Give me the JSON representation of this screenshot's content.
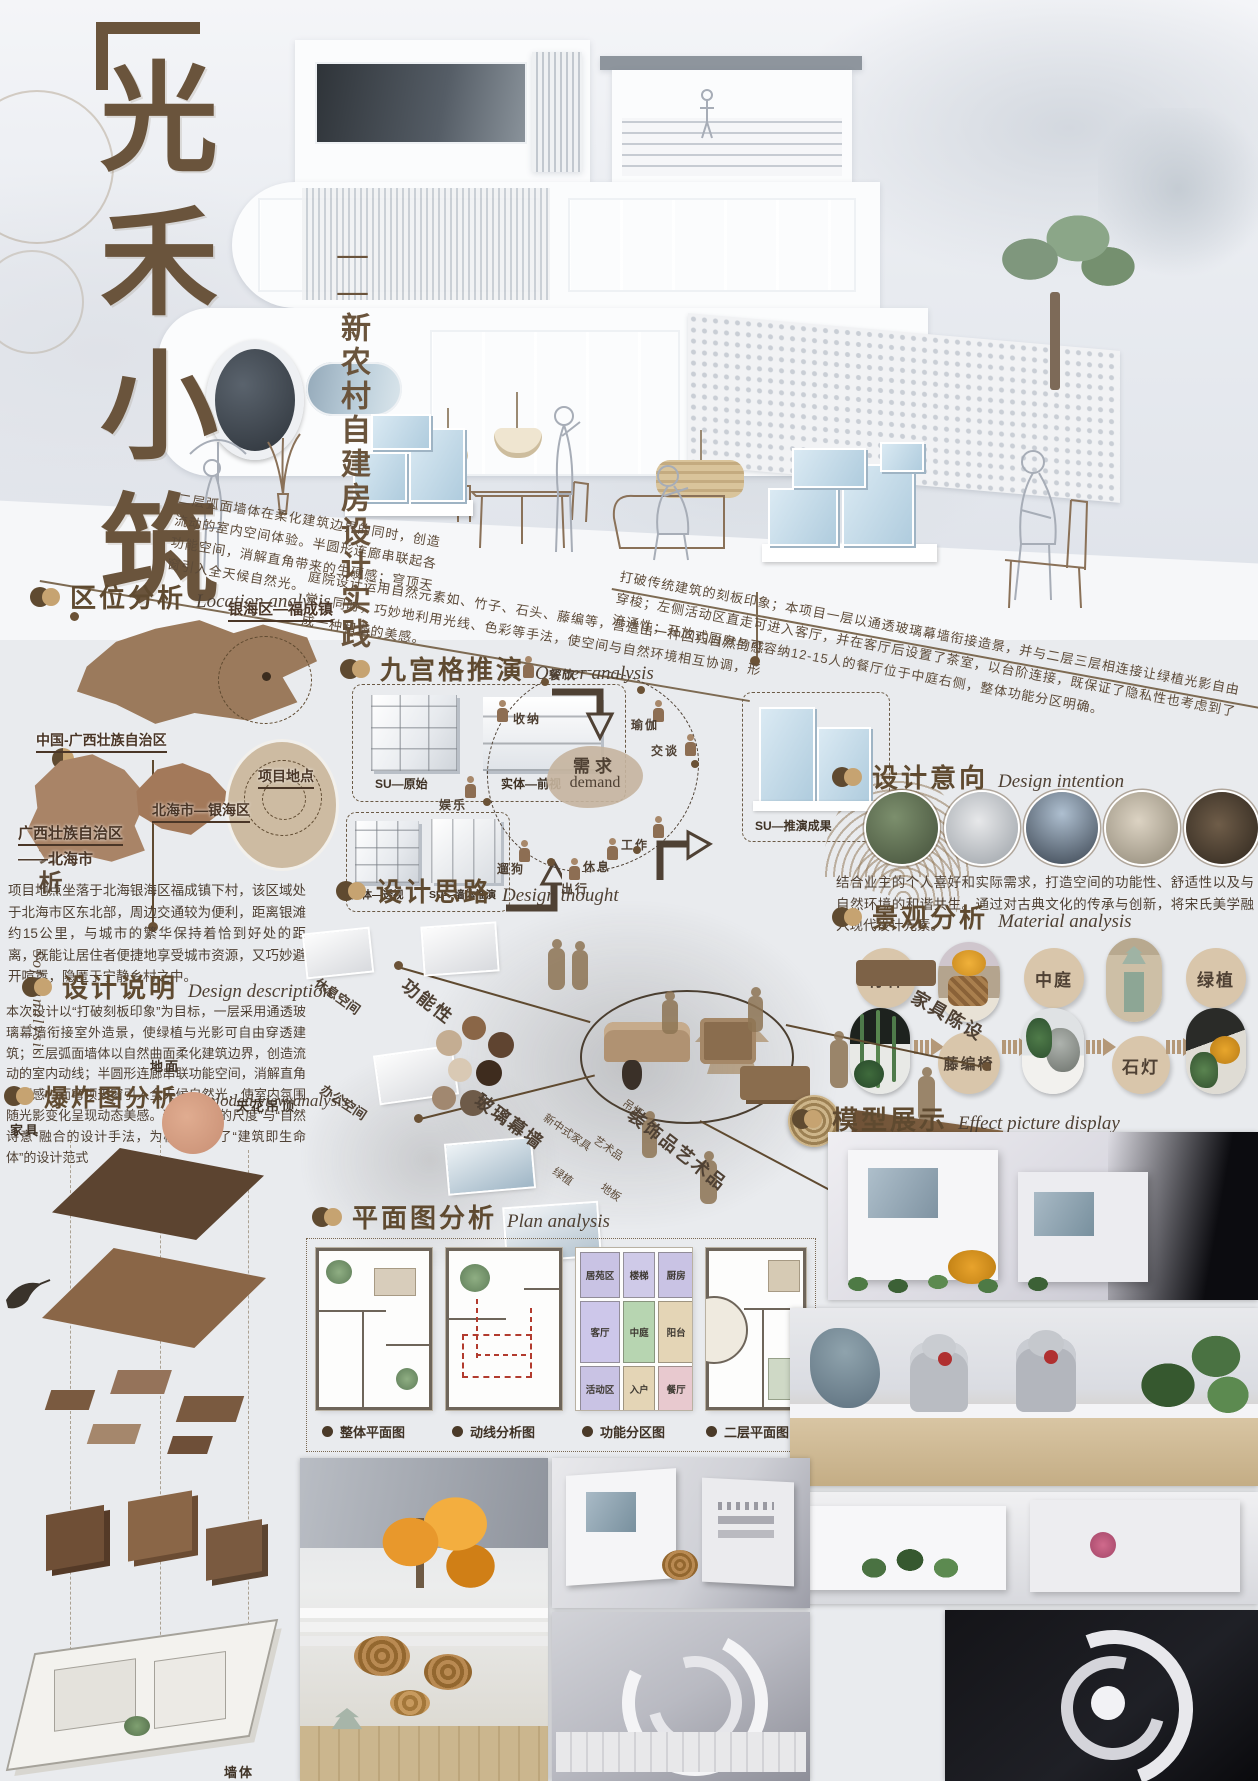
{
  "poster": {
    "title_chars": [
      "光",
      "禾",
      "小",
      "筑"
    ],
    "subtitle": "——新农村自建房设计实践",
    "side": {
      "zh": "项目分析",
      "en": "Soft analysis"
    }
  },
  "notes": {
    "soft": "二层弧面墙体在柔化建筑边界的同时，创造流动的室内空间体验。半圆形连廊串联起各功能空间，消解直角带来的生硬感；穹顶天窗引入全天候自然光。",
    "courtyard": "庭院设计运用自然元素如、竹子、石头、藤编等，营造出一种回归自然的感觉。同时，巧妙地利用光线、色彩等手法，使空间与自然环境相互协调，形成一种和谐的美感。",
    "concept": "打破传统建筑的刻板印象；本项目一层以通透玻璃幕墙衔接造景，并与二层三层相连接让绿植光影自由穿梭；左侧活动区直走可进入客厅，并在客厅后设置了茶室，以台阶连接，既保证了隐私性也考虑到了流通性；开放式厨房与可容纳12-15人的餐厅位于中庭右侧，整体功能分区明确。"
  },
  "location": {
    "title": "区位分析",
    "en": "Location analysis",
    "labels": {
      "china": "中国-广西壮族自治区",
      "town": "银海区—福成镇",
      "district": "北海市—银海区",
      "province": "广西壮族自治区",
      "province2": "——北海市",
      "site": "项目地点"
    },
    "body": "项目地点坐落于北海银海区福成镇下村，该区域处于北海市区东北部，周边交通较为便利，距离银滩约15公里，与城市的繁华保持着恰到好处的距离，既能让居住者便捷地享受城市资源，又巧妙避开喧嚣，隐匿于宁静乡村之中。"
  },
  "owner": {
    "title": "九宫格推演",
    "en": "Owner analysis",
    "models": [
      "SU—原始",
      "实体—前视",
      "实体—透视",
      "SU—墙体推演",
      "SU—推演成果"
    ],
    "demand": {
      "zh": "需求",
      "en": "demand",
      "items": [
        "餐饮",
        "收纳",
        "瑜伽",
        "交谈",
        "工作",
        "休息",
        "出行",
        "遛狗",
        "娱乐"
      ]
    }
  },
  "description": {
    "title": "设计说明",
    "en": "Design description",
    "body": "本次设计以“打破刻板印象”为目标，一层采用通透玻璃幕墙衔接室外造景，使绿植与光影可自由穿透建筑；二层弧面墙体以自然曲面柔化建筑边界，创造流动的室内动线；半圆形连廊串联功能空间，消解直角生硬感，而穹顶天窗引入全天候自然光，使室内氛围随光影变化呈现动态美感。这种将“人的尺度”与“自然诗意”融合的设计手法，为模型提供了“建筑即生命体”的设计范式"
  },
  "intention": {
    "title": "设计意向",
    "en": "Design intention",
    "body": "结合业主的个人喜好和实际需求，打造空间的功能性、舒适性以及与自然环境的和谐共生。通过对古典文化的传承与创新，将宋氏美学融入现代设计元素。"
  },
  "thought": {
    "title": "设计思路",
    "en": "Design thought",
    "labels": {
      "rest": "休息空间",
      "office": "办公空间",
      "function": "功能性",
      "glass": "玻璃幕墙",
      "furniture": "家具陈设",
      "decor": "装饰品艺术品",
      "plant": "绿植",
      "art": "艺术品",
      "floor": "地板",
      "newchinese": "新中式家具",
      "lamp": "吊灯"
    }
  },
  "material": {
    "title": "景观分析",
    "en": "Material analysis",
    "chain": [
      "竹林",
      "藤编椅",
      "中庭",
      "石灯",
      "绿植"
    ]
  },
  "exploded": {
    "title": "爆炸图分析",
    "en": "Exploded view analysis",
    "labels": {
      "ground": "地面",
      "ceiling": "天花吊顶",
      "furniture": "家具",
      "cabinet": "柜体",
      "wall": "墙体"
    }
  },
  "plan": {
    "title": "平面图分析",
    "en": "Plan analysis",
    "rooms": [
      {
        "name": "居苑区",
        "color": "#c9c3e4"
      },
      {
        "name": "楼梯",
        "color": "#cfcae8"
      },
      {
        "name": "厨房",
        "color": "#c9c3e4"
      },
      {
        "name": "客厅",
        "color": "#cdc7ea"
      },
      {
        "name": "中庭",
        "color": "#b7d5b1"
      },
      {
        "name": "阳台",
        "color": "#e4d5b6"
      },
      {
        "name": "活动区",
        "color": "#c9c3e4"
      },
      {
        "name": "入户",
        "color": "#e4d5b6"
      },
      {
        "name": "餐厅",
        "color": "#e8c9cf"
      }
    ],
    "legend": [
      "整体平面图",
      "动线分析图",
      "功能分区图",
      "二层平面图"
    ]
  },
  "model_display": {
    "title": "模型展示",
    "en": "Effect picture display"
  },
  "colors": {
    "accent_brown": "#6b5236",
    "tan": "#c6a371",
    "bg": "#e9ebee",
    "map_brown": "#9b7a5c",
    "flow_red": "#c0392b",
    "glass_blue": "#aecbdd"
  }
}
